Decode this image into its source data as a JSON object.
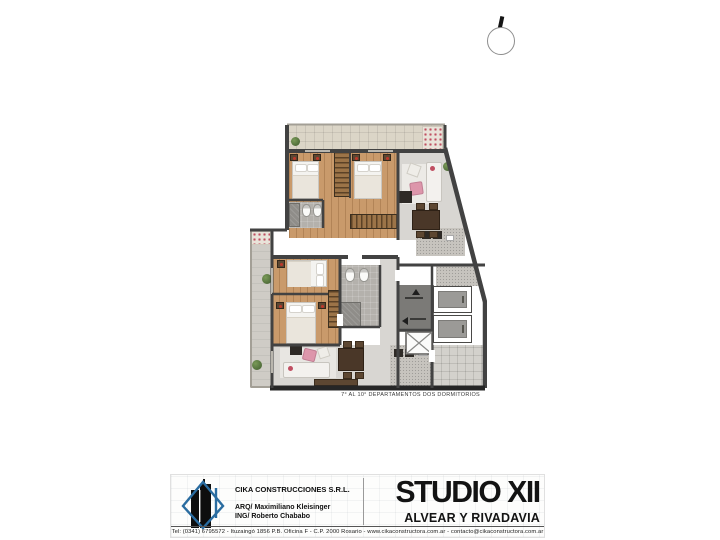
{
  "plan": {
    "caption": "7° AL 10° DEPARTAMENTOS DOS DORMITORIOS"
  },
  "footer": {
    "company": "CIKA CONSTRUCCIONES S.R.L.",
    "credit_arq": "ARQ/ Maximiliano Kleisinger",
    "credit_ing": "ING/ Roberto Chababo",
    "contact": "Tel: (0341) 6795572 - Ituzaingó 1856 P.B. Oficina F - C.P. 2000 Rosario - www.cikaconstructora.com.ar - contacto@cikaconstructora.com.ar",
    "title": "STUDIO XII",
    "subtitle": "ALVEAR Y RIVADAVIA"
  },
  "palette": {
    "wall": "#424242",
    "wood_floor": "#c99a6b",
    "terrace_tile": "#dbd5c7",
    "bathroom_tile": "#b4b1ac",
    "living_floor": "#d8d6d2",
    "balcony": "#cfccc6",
    "stairwell": "#7b7a77",
    "brand_blue": "#2a6ca0",
    "flower_red": "#c04f62",
    "plant_green": "#4d6b39",
    "sofa_pink": "#dd96ab"
  }
}
